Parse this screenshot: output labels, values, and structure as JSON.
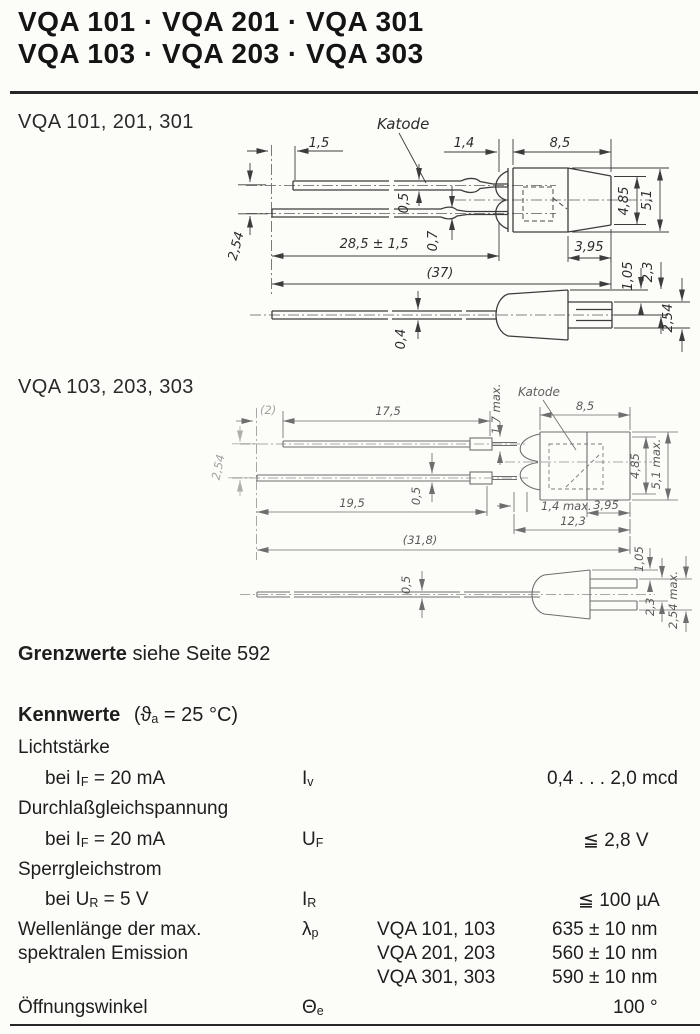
{
  "header": {
    "title_line1": "VQA 101 · VQA 201 · VQA 301",
    "title_line2": "VQA 103 · VQA 203 · VQA 303"
  },
  "drawing1": {
    "label": "VQA 101, 201, 301",
    "katode": "Katode",
    "dims": {
      "lead_offset": "1,5",
      "lead_pitch": "2,54",
      "dome_depth": "1,4",
      "body_length": "8,5",
      "lead_thickness_top": "0,5",
      "lead_thickness_bottom": "0,7",
      "lead_length": "28,5 ± 1,5",
      "total_length": "(37)",
      "dia_inner": "4,85",
      "dia_outer": "5,1",
      "front_length": "3,95",
      "step_1": "1,05",
      "step_2": "2,3",
      "side_pitch": "2,54",
      "side_lead_thickness": "0,4"
    }
  },
  "drawing2": {
    "label": "VQA 103, 203, 303",
    "katode": "Katode",
    "dims": {
      "lead_offset": "(2)",
      "lead_length_top": "17,5",
      "collar": "1,7 max.",
      "body_length": "8,5",
      "lead_pitch": "2,54",
      "lead_length_bottom": "19,5",
      "lead_thickness": "0,5",
      "dome_depth": "1,4 max.",
      "front_length": "3,95",
      "body_total": "12,3",
      "total_length": "(31,8)",
      "dia_inner": "4,85",
      "dia_outer": "5,1 max.",
      "side_lead_thickness": "0,5",
      "step_1": "1,05",
      "step_2": "2,3",
      "side_pitch": "2,54 max."
    }
  },
  "grenzwerte": {
    "bold": "Grenzwerte",
    "rest": " siehe Seite 592"
  },
  "kennwerte": {
    "heading": "Kennwerte",
    "cond_pre": "(ϑ",
    "cond_sub": "a",
    "cond_post": " = 25 °C)",
    "rows": {
      "licht": {
        "param": "Lichtstärke",
        "cond_pre": "bei I",
        "cond_sub": "F",
        "cond_post": " = 20 mA",
        "sym": "I",
        "sym_sub": "v",
        "value": "0,4 . . . 2,0 mcd"
      },
      "durchlass": {
        "param": "Durchlaßgleichspannung",
        "cond_pre": "bei I",
        "cond_sub": "F",
        "cond_post": " = 20 mA",
        "sym": "U",
        "sym_sub": "F",
        "value": "≦ 2,8 V"
      },
      "sperr": {
        "param": "Sperrgleichstrom",
        "cond_pre": "bei U",
        "cond_sub": "R",
        "cond_post": " = 5 V",
        "sym": "I",
        "sym_sub": "R",
        "value": "≦ 100 µA"
      },
      "wellen": {
        "param_line1": "Wellenlänge der max.",
        "param_line2": "spektralen Emission",
        "sym": "λ",
        "sym_sub": "p",
        "variants": [
          {
            "types": "VQA 101, 103",
            "value": "635 ± 10 nm"
          },
          {
            "types": "VQA 201, 203",
            "value": "560 ± 10 nm"
          },
          {
            "types": "VQA 301, 303",
            "value": "590 ± 10 nm"
          }
        ]
      },
      "winkel": {
        "param": "Öffnungswinkel",
        "sym": "Θ",
        "sym_sub": "e",
        "value": "100 °"
      }
    }
  }
}
